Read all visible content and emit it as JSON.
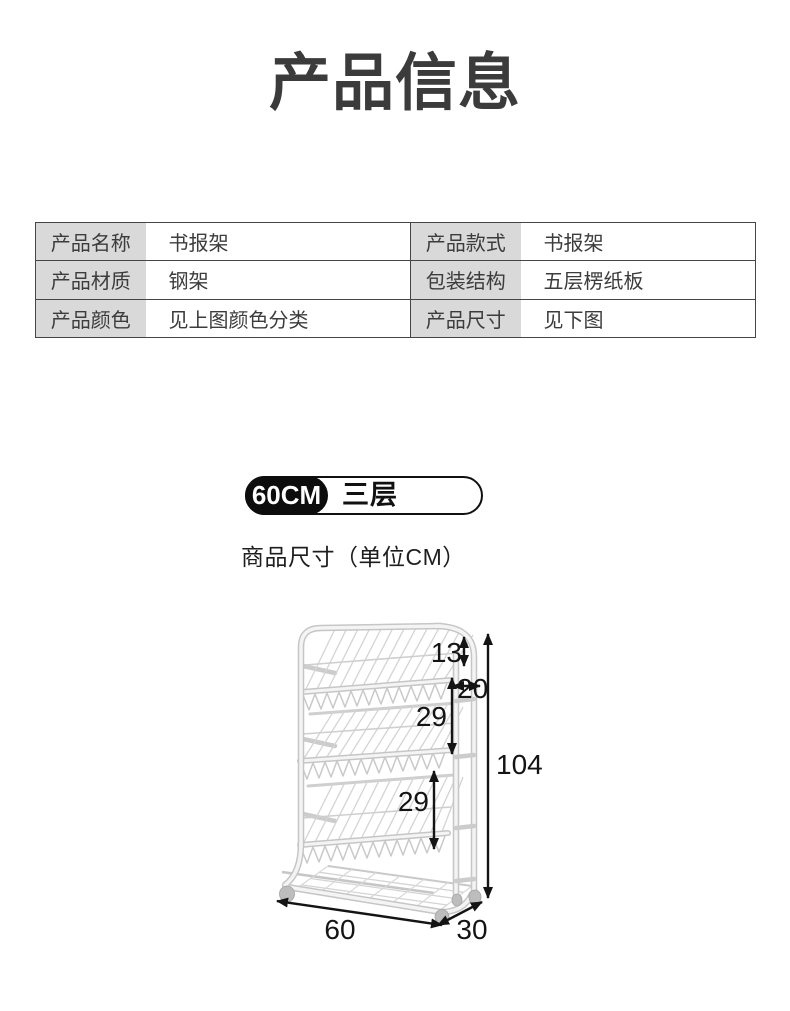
{
  "page": {
    "title": "产品信息"
  },
  "spec_table": {
    "rows": [
      {
        "left": {
          "label": "产品名称",
          "value": "书报架"
        },
        "right": {
          "label": "产品款式",
          "value": "书报架"
        }
      },
      {
        "left": {
          "label": "产品材质",
          "value": "钢架"
        },
        "right": {
          "label": "包装结构",
          "value": "五层楞纸板"
        }
      },
      {
        "left": {
          "label": "产品颜色",
          "value": "见上图颜色分类"
        },
        "right": {
          "label": "产品尺寸",
          "value": "见下图"
        }
      }
    ]
  },
  "size_badge": {
    "size": "60CM",
    "tier": "三层"
  },
  "dimension_caption": "商品尺寸（单位CM）",
  "diagram": {
    "unit": "CM",
    "labels": {
      "top_height": "13",
      "upper_gap": "20",
      "shelf_gap_upper": "29",
      "shelf_gap_lower": "29",
      "total_height": "104",
      "width": "60",
      "depth": "30"
    },
    "dimensions_cm": {
      "top_section": 13,
      "upper_section": 20,
      "middle_section": 29,
      "lower_section": 29,
      "total_height": 104,
      "width": 60,
      "depth": 30
    }
  },
  "colors": {
    "title_text": "#3b3b3b",
    "table_label_bg": "#d9d9d9",
    "table_border": "#454545",
    "badge_black": "#0d0d0d",
    "dimension_ink": "#141414",
    "rack_line": "#c6c6c6"
  }
}
